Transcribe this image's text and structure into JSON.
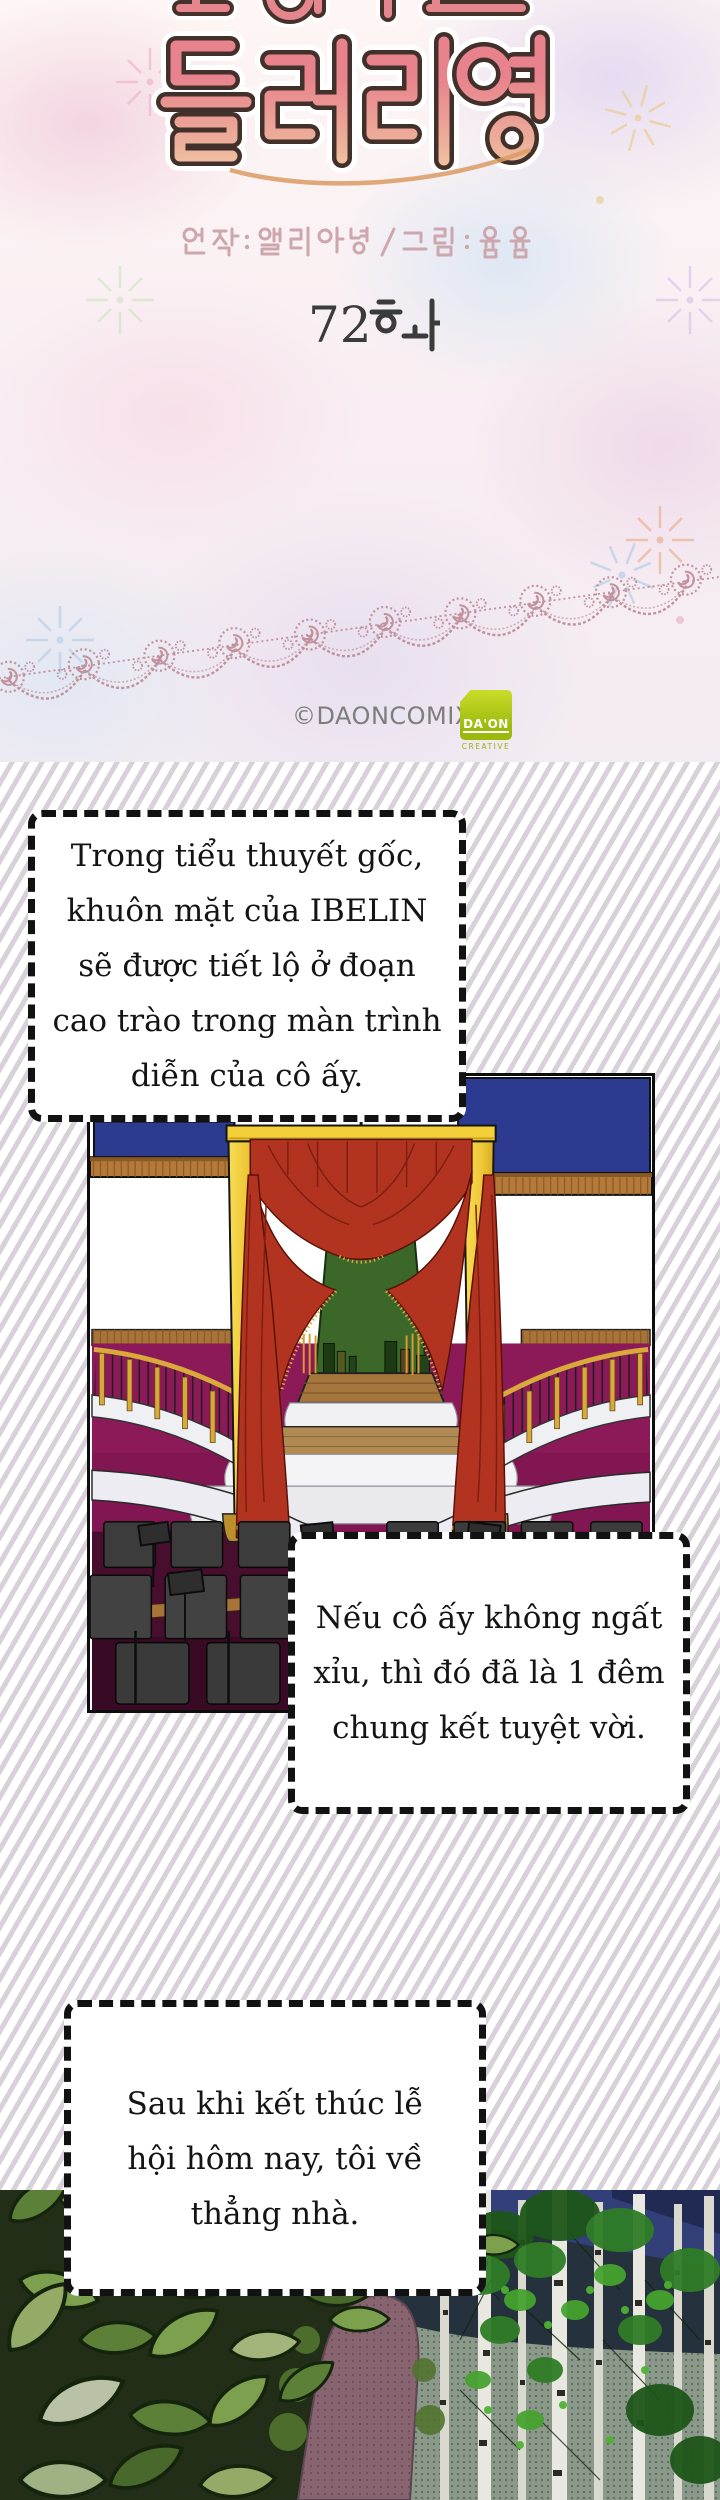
{
  "header": {
    "series_title": "들러리양",
    "credits": "원작 : 엘리아냥 / 그림 : 윰윰",
    "episode_label": "72화",
    "episode_number": "72",
    "copyright": "©DAONCOMIX",
    "logo": {
      "name": "DA'ON",
      "subtitle": "CREATIVE"
    }
  },
  "speech_bubbles": [
    {
      "id": "bubble-1",
      "lines": [
        "Trong tiểu thuyết gốc,",
        "khuôn mặt của IBELIN",
        "sẽ được tiết lộ ở đoạn",
        "cao trào trong màn trình",
        "diễn của cô ấy."
      ]
    },
    {
      "id": "bubble-2",
      "lines": [
        "Nếu cô ấy không ngất",
        "xỉu, thì đó đã là 1 đêm",
        "chung kết tuyệt vời."
      ]
    },
    {
      "id": "bubble-3",
      "lines": [
        "Sau khi kết thúc lễ",
        "hội hôm nay, tôi về",
        "thẳng nhà."
      ]
    }
  ],
  "colors": {
    "curtain_red": "#b23420",
    "proscenium_gold": "#f3cf3a",
    "backdrop_green": "#3b6829",
    "floor_magenta": "#8c1a58",
    "wall_navy": "#2c3a8f",
    "stripe_lavender": "#d8d1da",
    "lace_pink": "#b9838f",
    "logo_green": "#9ab90c",
    "episode_text": "#3b3b3b",
    "copyright_gray": "#7d7d7d"
  }
}
